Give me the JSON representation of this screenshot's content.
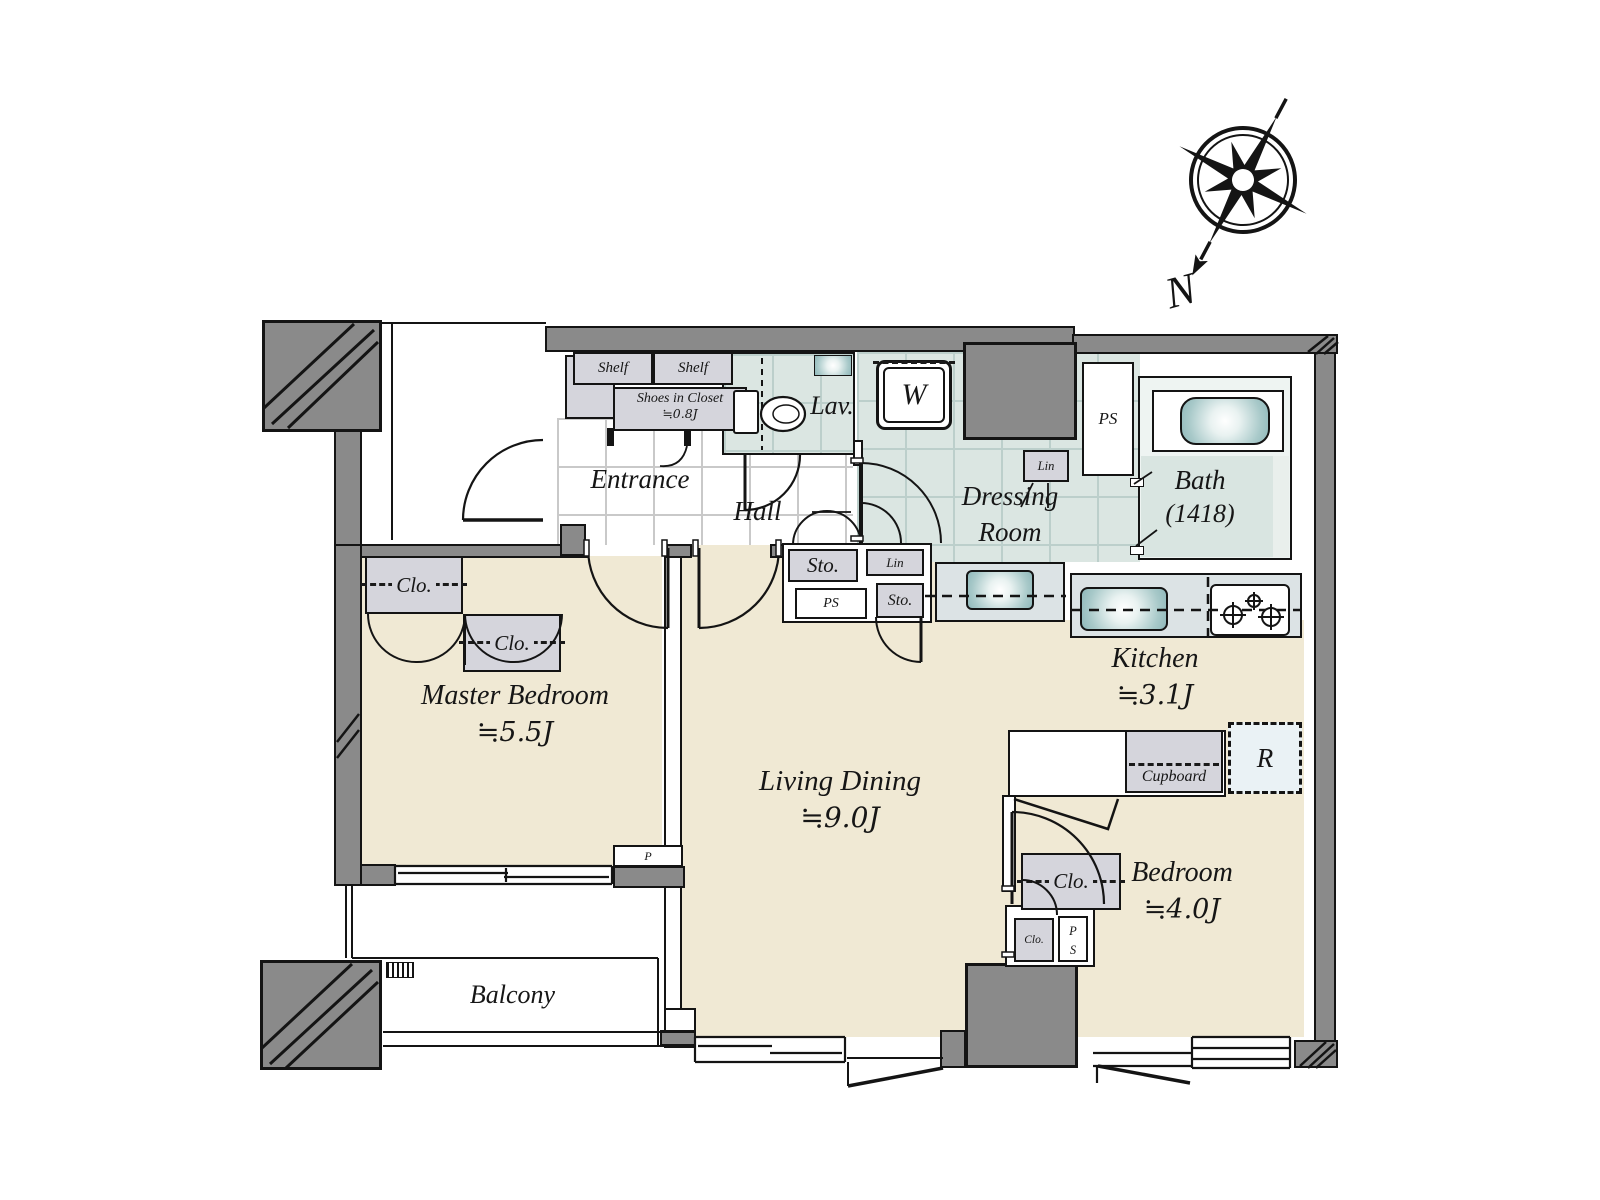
{
  "colors": {
    "floor_beige": "#f0e9d4",
    "wet_area_teal": "#dbe6e2",
    "wall_gray": "#8a8a8a",
    "cabinet_gray": "#d5d5dc",
    "counter_gray": "#dce3e5",
    "tub_teal": "#8fb8ba",
    "fridge_blue": "#eaf2f5"
  },
  "compass": {
    "north_label": "N"
  },
  "rooms": {
    "entrance": {
      "label": "Entrance"
    },
    "hall": {
      "label": "Hall"
    },
    "lavatory": {
      "label": "Lav."
    },
    "dressing_room": {
      "label_line1": "Dressing",
      "label_line2": "Room"
    },
    "bath": {
      "label": "Bath",
      "size": "(1418)"
    },
    "kitchen": {
      "label": "Kitchen",
      "size": "≒3.1J"
    },
    "living_dining": {
      "label": "Living Dining",
      "size": "≒9.0J"
    },
    "master_bedroom": {
      "label": "Master Bedroom",
      "size": "≒5.5J"
    },
    "bedroom": {
      "label": "Bedroom",
      "size": "≒4.0J"
    },
    "balcony": {
      "label": "Balcony"
    }
  },
  "fixtures": {
    "shelf_left": {
      "label": "Shelf"
    },
    "shelf_right": {
      "label": "Shelf"
    },
    "shoes_closet": {
      "label": "Shoes in Closet",
      "size": "≒0.8J"
    },
    "washing_machine": {
      "label": "W"
    },
    "pipe_space_top": {
      "label": "PS"
    },
    "linen_dressing": {
      "label": "Lin"
    },
    "storage_hall_1": {
      "label": "Sto."
    },
    "linen_hall": {
      "label": "Lin"
    },
    "pipe_space_hall": {
      "label": "PS"
    },
    "storage_hall_2": {
      "label": "Sto."
    },
    "closet_master_left": {
      "label": "Clo."
    },
    "closet_master_right": {
      "label": "Clo."
    },
    "closet_kitchen": {
      "label": "Clo."
    },
    "cupboard": {
      "label": "Cupboard"
    },
    "refrigerator": {
      "label": "R"
    },
    "closet_bedroom": {
      "label": "Clo."
    },
    "pipe_space_bedroom": {
      "label_line1": "P",
      "label_line2": "S"
    },
    "pipe_duct": {
      "label": "P"
    }
  }
}
